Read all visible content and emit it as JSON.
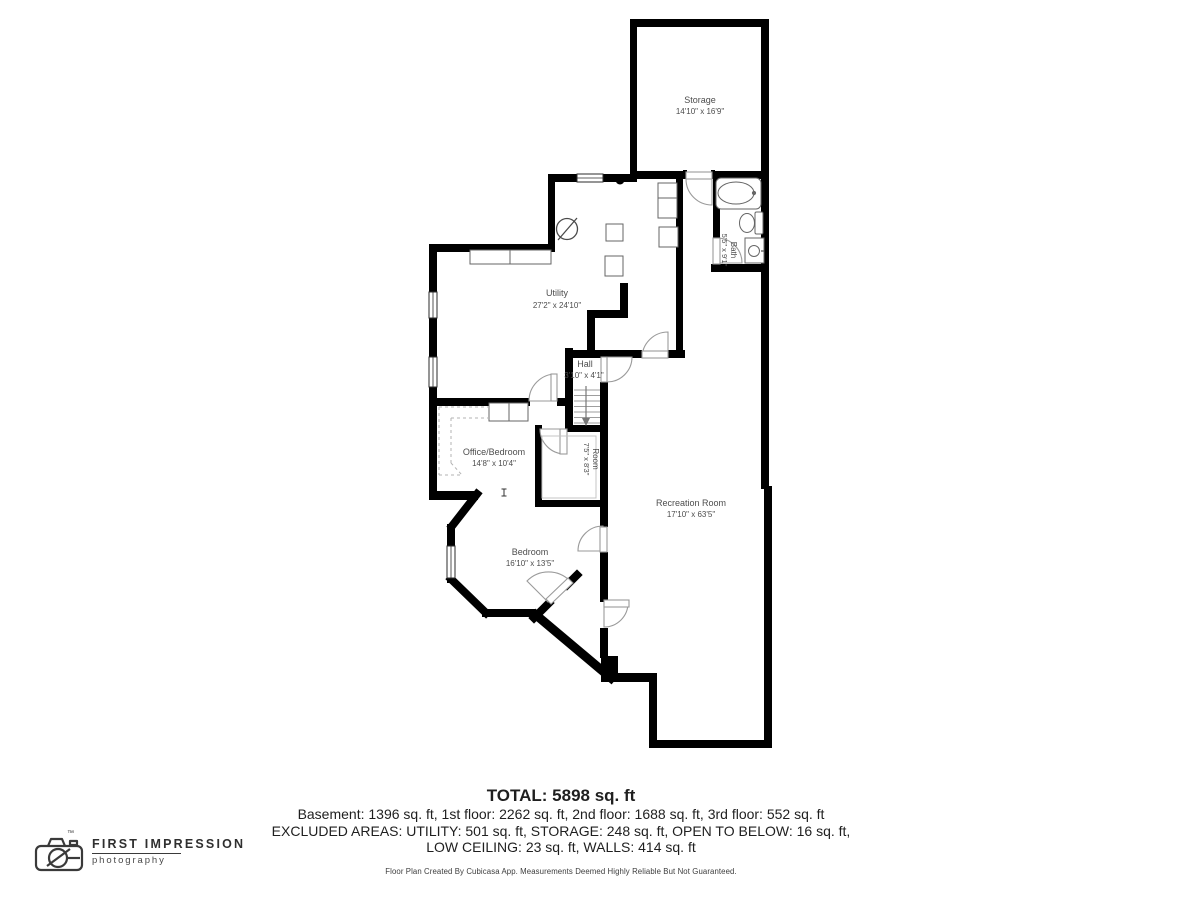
{
  "rooms": {
    "storage": {
      "name": "Storage",
      "dims": "14'10\" x 16'9\""
    },
    "utility": {
      "name": "Utility",
      "dims": "27'2\" x 24'10\""
    },
    "bath": {
      "name": "Bath",
      "dims": "5'5\" x 9'1\""
    },
    "hall": {
      "name": "Hall",
      "dims": "3'10\" x 4'1\""
    },
    "office_bedroom": {
      "name": "Office/Bedroom",
      "dims": "14'8\" x 10'4\""
    },
    "room": {
      "name": "Room",
      "dims": "7'5\" x 8'3\""
    },
    "recreation": {
      "name": "Recreation Room",
      "dims": "17'10\" x 63'5\""
    },
    "bedroom": {
      "name": "Bedroom",
      "dims": "16'10\" x 13'5\""
    }
  },
  "summary": {
    "total": "TOTAL: 5898 sq. ft",
    "floors": "Basement: 1396 sq. ft, 1st floor: 2262 sq. ft, 2nd floor: 1688 sq. ft, 3rd floor: 552 sq. ft",
    "excluded_1": "EXCLUDED AREAS: UTILITY: 501 sq. ft, STORAGE: 248 sq. ft, OPEN TO BELOW: 16 sq. ft,",
    "excluded_2": "LOW CEILING: 23 sq. ft, WALLS: 414 sq. ft",
    "disclaimer": "Floor Plan Created By Cubicasa App. Measurements Deemed Highly Reliable But Not Guaranteed."
  },
  "logo": {
    "brand": "FIRST IMPRESSION",
    "sub": "photography",
    "tm": "™"
  },
  "colors": {
    "wall": "#000000",
    "label": "#4d4d4d",
    "door": "#9a9a9a",
    "fixture": "#666666"
  }
}
